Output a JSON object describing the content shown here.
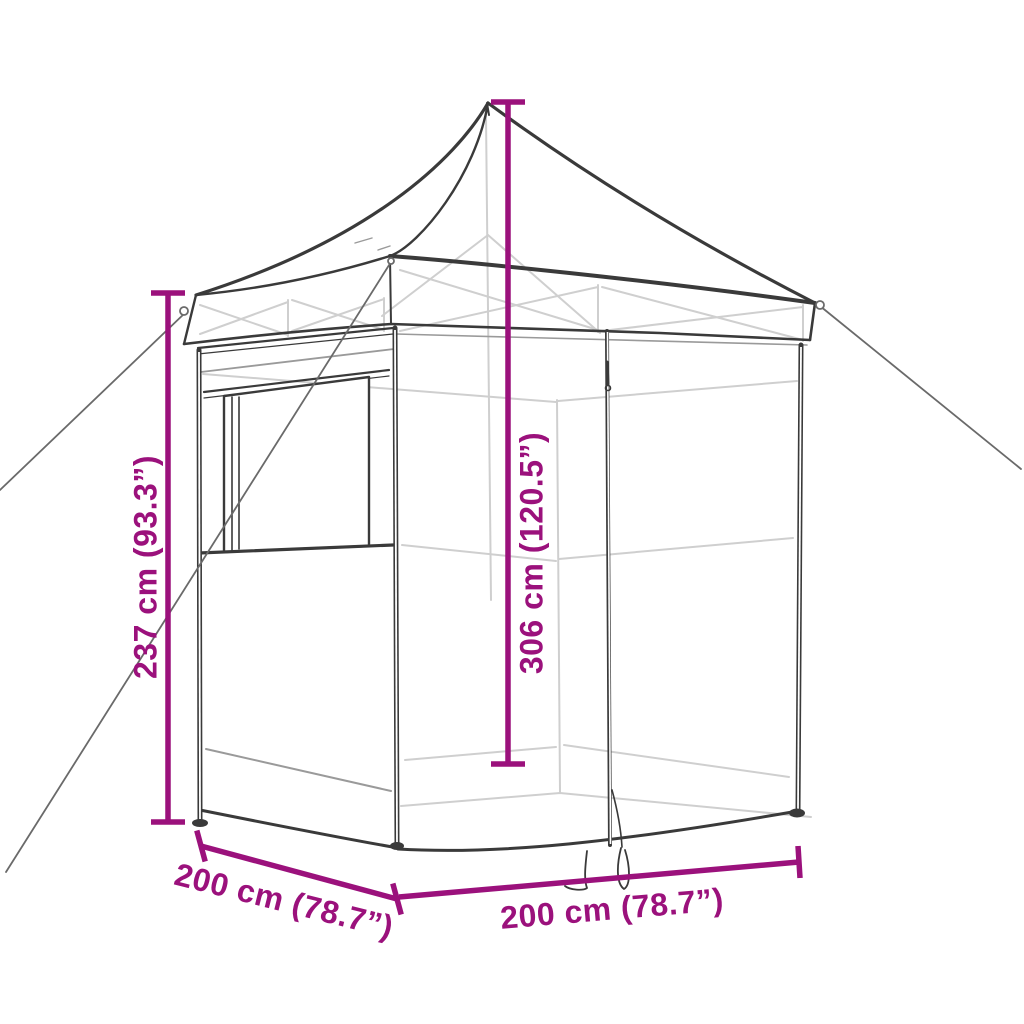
{
  "diagram": {
    "labels": {
      "height_side": "237 cm (93.3”)",
      "height_total": "306 cm (120.5”)",
      "depth": "200 cm (78.7”)",
      "width": "200 cm (78.7”)"
    }
  },
  "colors": {
    "accent": "#9B117C",
    "ink": "#3A3A3A",
    "mid_line": "#9A9A9A",
    "rope": "#6A6A6A",
    "faint": "#CFCFCF",
    "background": "#FFFFFF"
  }
}
